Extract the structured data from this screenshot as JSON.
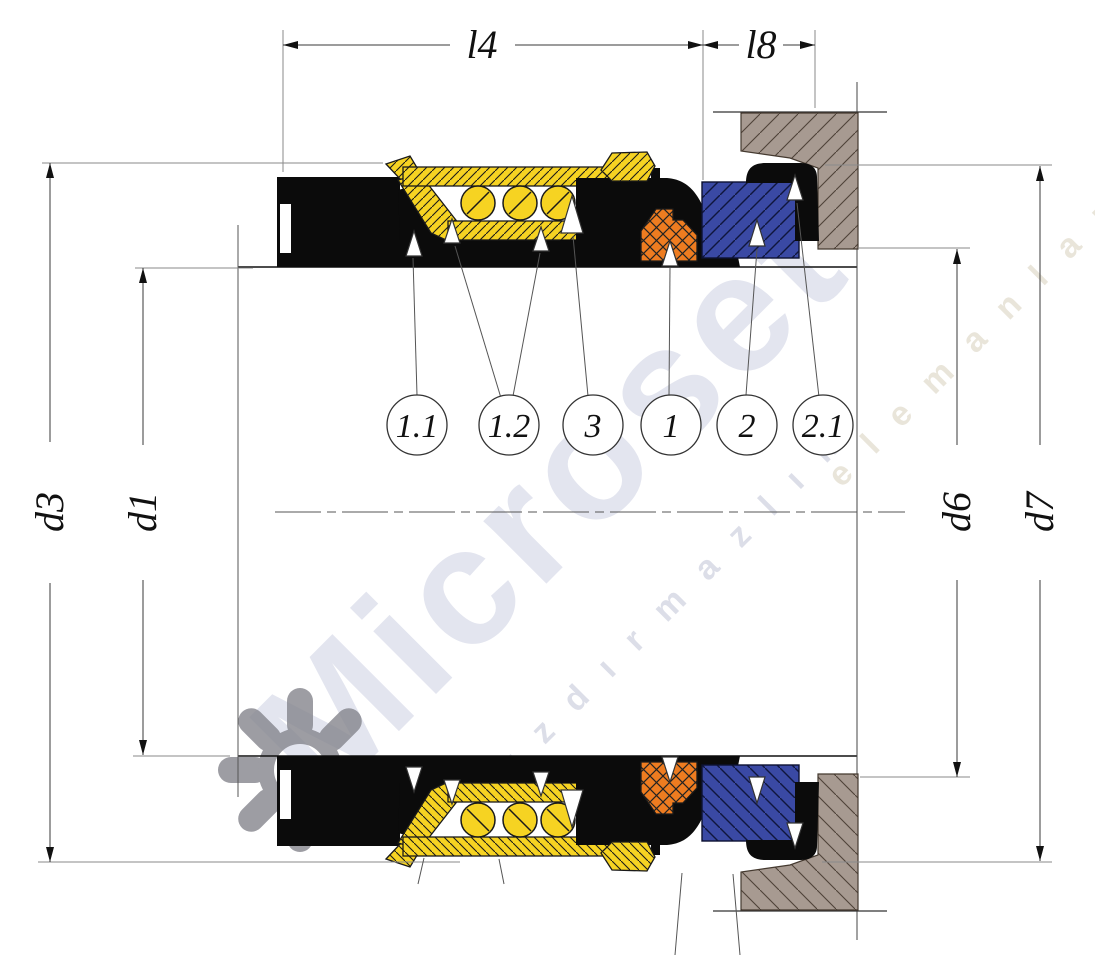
{
  "drawing": {
    "type": "mechanical-seal-cross-section",
    "dimensions": {
      "l4": "l4",
      "l8": "l8",
      "d3": "d3",
      "d1": "d1",
      "d6": "d6",
      "d7": "d7"
    },
    "callouts": [
      {
        "label": "1.1"
      },
      {
        "label": "1.2"
      },
      {
        "label": "3"
      },
      {
        "label": "1"
      },
      {
        "label": "2"
      },
      {
        "label": "2.1"
      }
    ],
    "watermark": {
      "brand": "Microset",
      "line1": "sızdırmazlık",
      "line2": "elemanları"
    },
    "colors": {
      "part_black": "#0b0b0b",
      "spring_yellow": "#f6d322",
      "wedge_orange": "#ee7c20",
      "seat_blue": "#3a49a4",
      "housing_taupe": "#a79a91",
      "outline": "#1a1a1a",
      "dim_line": "#3a3a3a",
      "watermark_light": "#e3e5ef",
      "watermark_small": "#dcdee8",
      "watermark_beige": "#e9e5da",
      "logo_gray": "#85858d"
    }
  }
}
